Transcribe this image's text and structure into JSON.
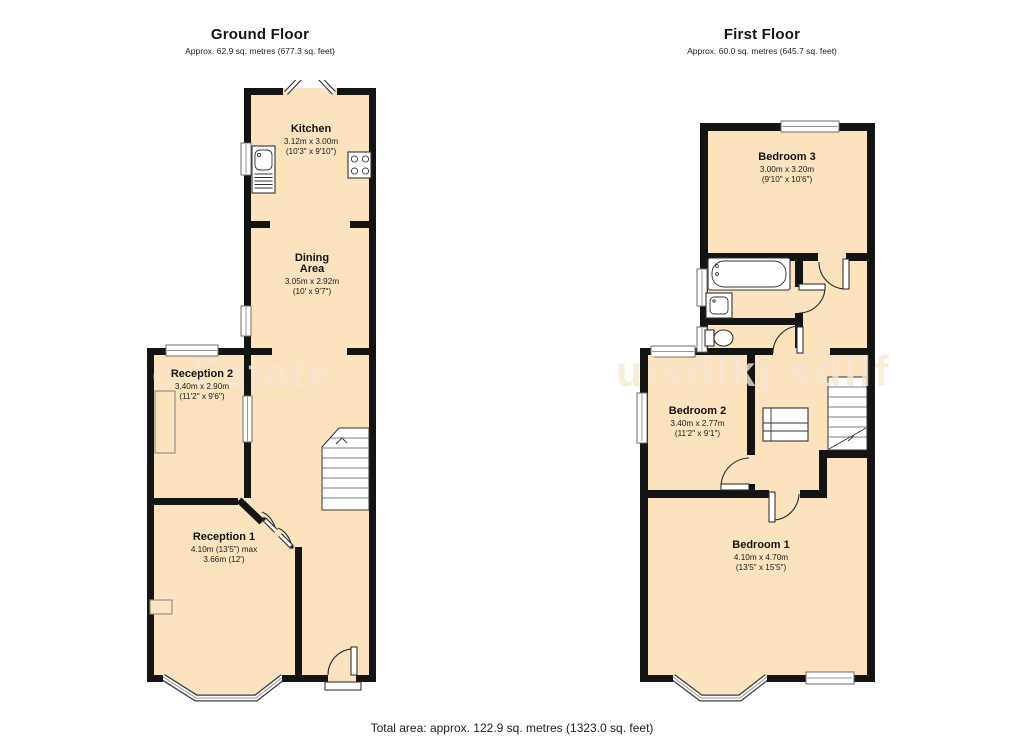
{
  "canvas": {
    "width": 1024,
    "height": 745,
    "background": "#ffffff"
  },
  "colors": {
    "room_fill": "#fbe3be",
    "wall": "#141414",
    "text": "#141414"
  },
  "ground_floor": {
    "title": "Ground Floor",
    "subtitle": "Approx.  62.9 sq. metres (677.3 sq. feet)",
    "rooms": [
      {
        "name": "Kitchen",
        "dim1": "3.12m x 3.00m",
        "dim2": "(10'3\" x 9'10\")"
      },
      {
        "name": "Dining Area",
        "dim1": "3.05m x 2.92m",
        "dim2": "(10' x 9'7\")"
      },
      {
        "name": "Reception 2",
        "dim1": "3.40m x 2.90m",
        "dim2": "(11'2\" x 9'6\")"
      },
      {
        "name": "Reception 1",
        "dim1": "4.10m (13'5\") max",
        "dim2": "3.66m (12')"
      }
    ],
    "features": [
      "french-doors",
      "kitchen-sink",
      "hob",
      "stairs",
      "bay-window",
      "front-door"
    ]
  },
  "first_floor": {
    "title": "First Floor",
    "subtitle": "Approx.  60.0 sq. metres (645.7 sq. feet)",
    "rooms": [
      {
        "name": "Bedroom 3",
        "dim1": "3.00m x 3.20m",
        "dim2": "(9'10\" x 10'6\")"
      },
      {
        "name": "Bedroom 2",
        "dim1": "3.40m x 2.77m",
        "dim2": "(11'2\" x 9'1\")"
      },
      {
        "name": "Bedroom 1",
        "dim1": "4.10m x 4.70m",
        "dim2": "(13'5\" x 15'5\")"
      }
    ],
    "features": [
      "bath",
      "basin",
      "toilet",
      "stairs",
      "cupboard",
      "bay-window"
    ]
  },
  "watermark": {
    "left": "c Estate",
    "right": "uisdlkj sdllf"
  },
  "footer": {
    "total_area": "Total area: approx. 122.9 sq. metres (1323.0 sq. feet)"
  }
}
